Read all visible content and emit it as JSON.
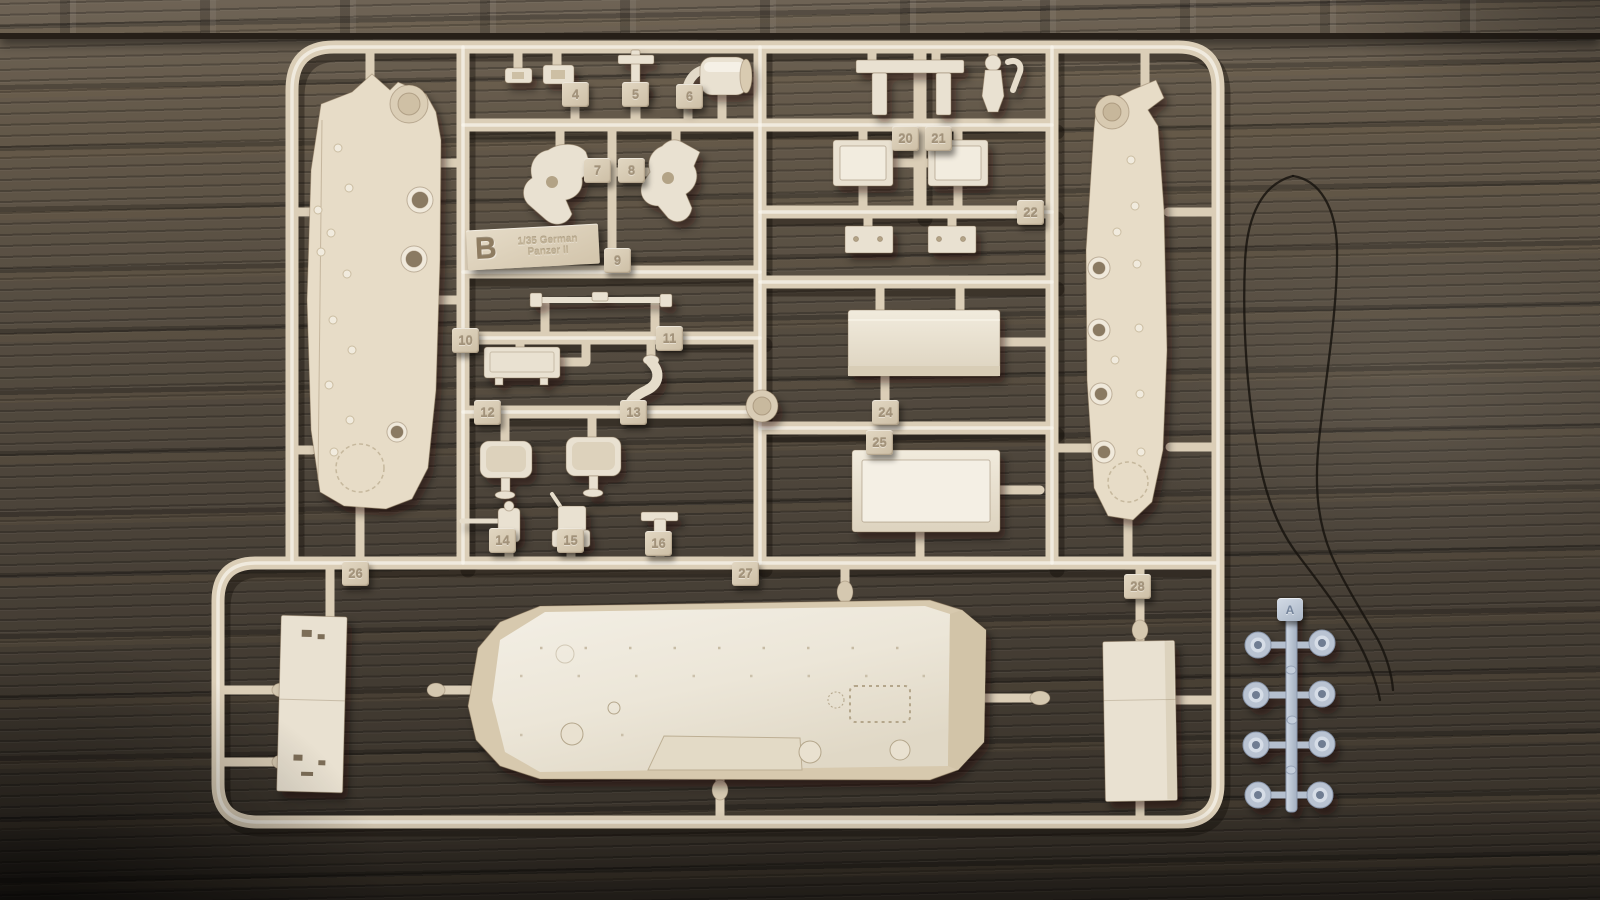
{
  "main_sprue": {
    "letter_tab": {
      "letter": "B",
      "line1": "1/35 German",
      "line2": "Panzer II"
    },
    "part_tabs": [
      "4",
      "5",
      "6",
      "7",
      "8",
      "9",
      "10",
      "11",
      "12",
      "13",
      "14",
      "15",
      "16",
      "20",
      "21",
      "22",
      "24",
      "25",
      "26",
      "27",
      "28"
    ]
  },
  "clear_sprue": {
    "letter_tab": "A"
  },
  "colors": {
    "sprue_tan": "#cdbfa6",
    "part_cream": "#e9e1d1",
    "clear_part": "#aab6c6",
    "wood_dark": "#433c33",
    "wood_light": "#7c6a52",
    "thread_black": "#16120e"
  }
}
